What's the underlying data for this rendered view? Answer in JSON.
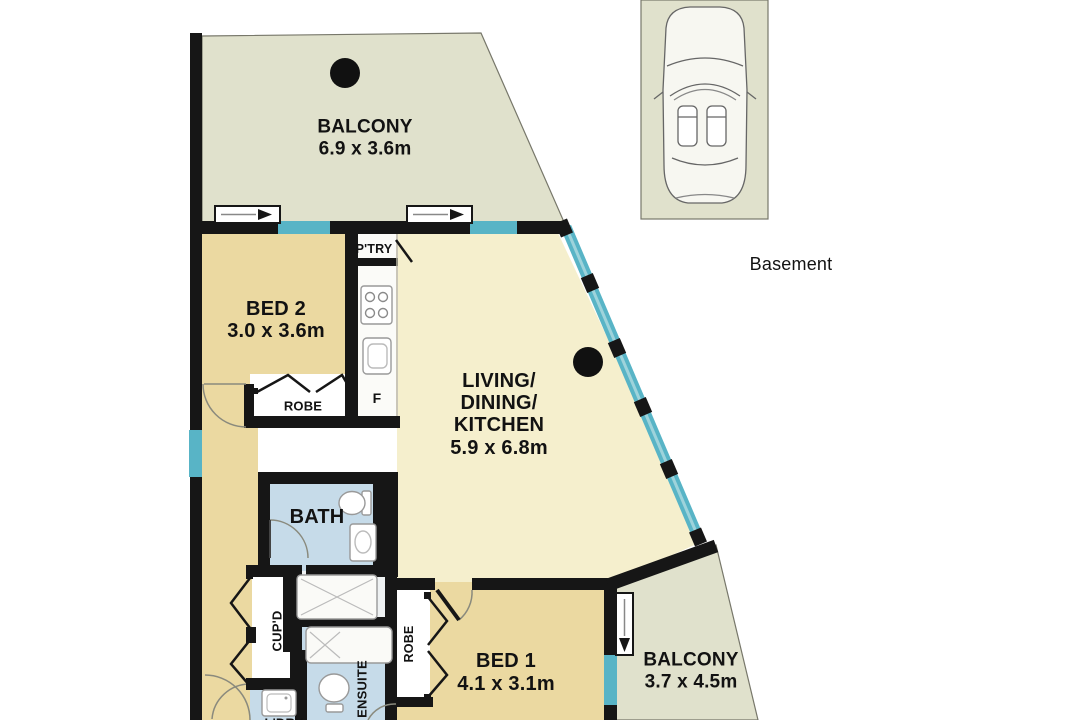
{
  "rooms": {
    "balcony_top": {
      "name": "BALCONY",
      "dims": "6.9 x 3.6m"
    },
    "bed2": {
      "name": "BED 2",
      "dims": "3.0 x 3.6m"
    },
    "living": {
      "line1": "LIVING/",
      "line2": "DINING/",
      "line3": "KITCHEN",
      "dims": "5.9 x 6.8m"
    },
    "bath": {
      "name": "BATH"
    },
    "ensuite": {
      "name": "ENSUITE"
    },
    "laundry": {
      "name": "L'DRY"
    },
    "bed1": {
      "name": "BED 1",
      "dims": "4.1 x 3.1m"
    },
    "balcony_bottom": {
      "name": "BALCONY",
      "dims": "3.7 x 4.5m"
    }
  },
  "labels": {
    "basement": "Basement",
    "pantry": "P'TRY",
    "fridge": "F",
    "robe_bed2": "ROBE",
    "robe_bed1": "ROBE",
    "cupboard": "CUP'D"
  },
  "colors": {
    "wall": "#161616",
    "floor_living": "#f5efcd",
    "floor_bedroom": "#ebd9a1",
    "floor_balcony": "#e0e1cc",
    "floor_wet": "#c6dbe9",
    "window_glass": "#58b4c6",
    "fixture_outline": "#999999",
    "background": "#ffffff"
  }
}
